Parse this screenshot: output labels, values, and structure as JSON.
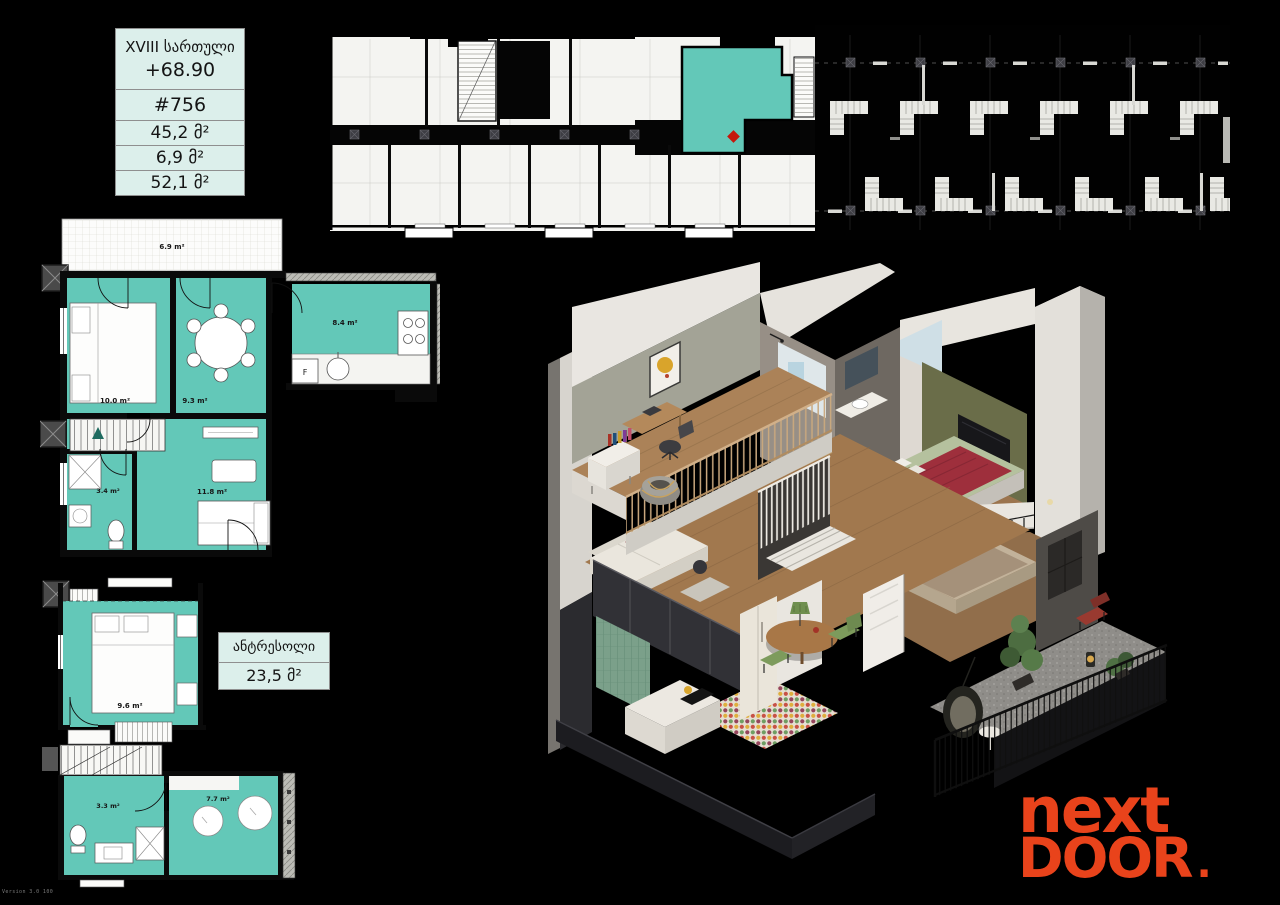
{
  "colors": {
    "page_bg": "#000000",
    "plan_teal": "#63c8b8",
    "panel_bg": "#dcefeb",
    "logo_orange": "#e9431b",
    "marker_red": "#c4170c"
  },
  "info_table": {
    "floor": "XVIII სართული",
    "elevation": "+68.90",
    "unit": "#756",
    "area_apartment": "45,2 მ²",
    "area_summer": "6,9 მ²",
    "area_total": "52,1 მ²"
  },
  "mezzanine_box": {
    "title": "ანტრესოლი",
    "area": "23,5 მ²"
  },
  "main_plan": {
    "balcony": "6.9 m²",
    "bedroom": "10.0 m²",
    "dining": "9.3 m²",
    "kitchen": "8.4 m²",
    "living": "11.8 m²",
    "bathroom": "3.4 m²",
    "fridge": "F"
  },
  "mezz_plan": {
    "bedroom": "9.6 m²",
    "bathroom": "3.3 m²",
    "dressing": "7.7 m²"
  },
  "logo": {
    "line1": "next",
    "line2": "DOOR",
    "dot": "."
  },
  "watermark": "Version 3.0 100"
}
